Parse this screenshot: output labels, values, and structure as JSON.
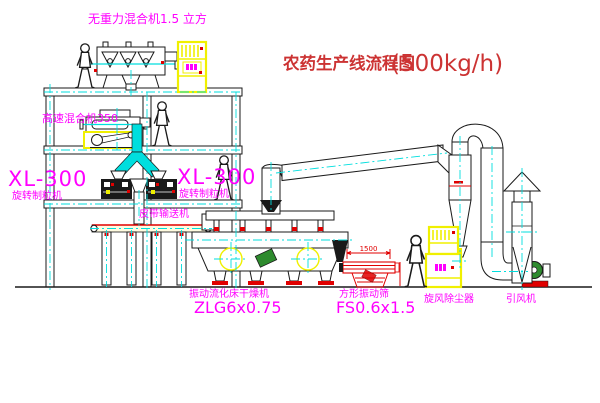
{
  "title": {
    "name": "农药生产线流程图",
    "capacity": "(500kg/h)"
  },
  "equipment_labels": {
    "gravity_mixer": "无重力混合机1.5 立方",
    "high_speed_mixer": "高速混合机350",
    "granulator_left_model": "XL-300",
    "granulator_left_name": "旋转制粒机",
    "granulator_right_model": "XL-300",
    "granulator_right_name": "旋转制粒机",
    "belt_conveyor": "皮带输送机",
    "dryer_name": "振动流化床干燥机",
    "dryer_model": "ZLG6x0.75",
    "screen_name": "方形振动筛",
    "screen_model": "FS0.6x1.5",
    "cyclone": "旋风除尘器",
    "fan": "引风机"
  },
  "dimensions": {
    "screen_width": "1500"
  },
  "colors": {
    "label": "#ff00ff",
    "title": "#cc3333",
    "centerline": "#00dede",
    "highlight": "#f0f000",
    "accent_red": "#e00000",
    "machine_green": "#2e8b2e"
  }
}
